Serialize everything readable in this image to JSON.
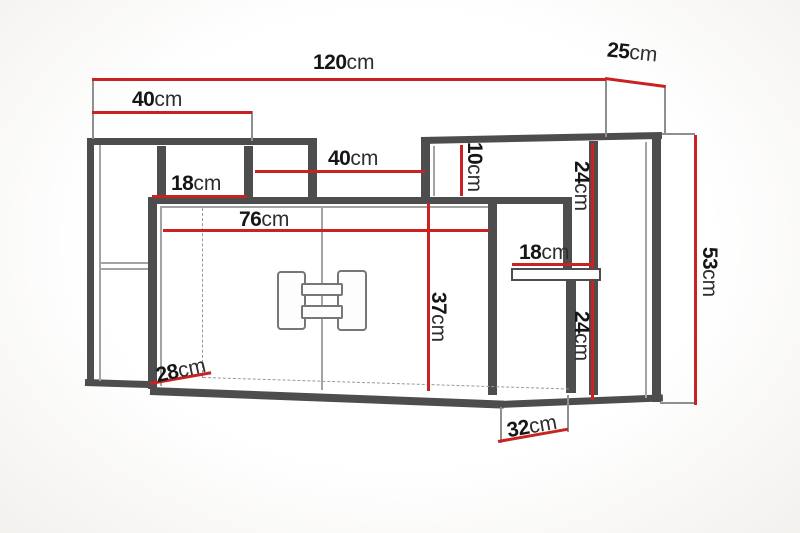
{
  "diagram": {
    "kind": "furniture dimension drawing",
    "unit": "cm"
  },
  "dimensions": {
    "total_width": {
      "num": "120",
      "unit": "cm"
    },
    "top_depth": {
      "num": "25",
      "unit": "cm"
    },
    "left_top_width": {
      "num": "40",
      "unit": "cm"
    },
    "left_niche_width": {
      "num": "18",
      "unit": "cm"
    },
    "middle_gap_width": {
      "num": "40",
      "unit": "cm"
    },
    "right_top_strip_height": {
      "num": "10",
      "unit": "cm"
    },
    "right_upper_niche_height": {
      "num": "24",
      "unit": "cm"
    },
    "total_height": {
      "num": "53",
      "unit": "cm"
    },
    "main_inner_width": {
      "num": "76",
      "unit": "cm"
    },
    "right_shelf_width": {
      "num": "18",
      "unit": "cm"
    },
    "main_inner_height": {
      "num": "37",
      "unit": "cm"
    },
    "right_lower_niche_height": {
      "num": "24",
      "unit": "cm"
    },
    "bottom_left_depth": {
      "num": "28",
      "unit": "cm"
    },
    "bottom_right_depth": {
      "num": "32",
      "unit": "cm"
    }
  },
  "colors": {
    "dimension_line": "#c92222",
    "outline_dark": "#4d4d4d",
    "outline_mid": "#7a7a7a",
    "background": "#faf9f7",
    "text": "#161616"
  }
}
